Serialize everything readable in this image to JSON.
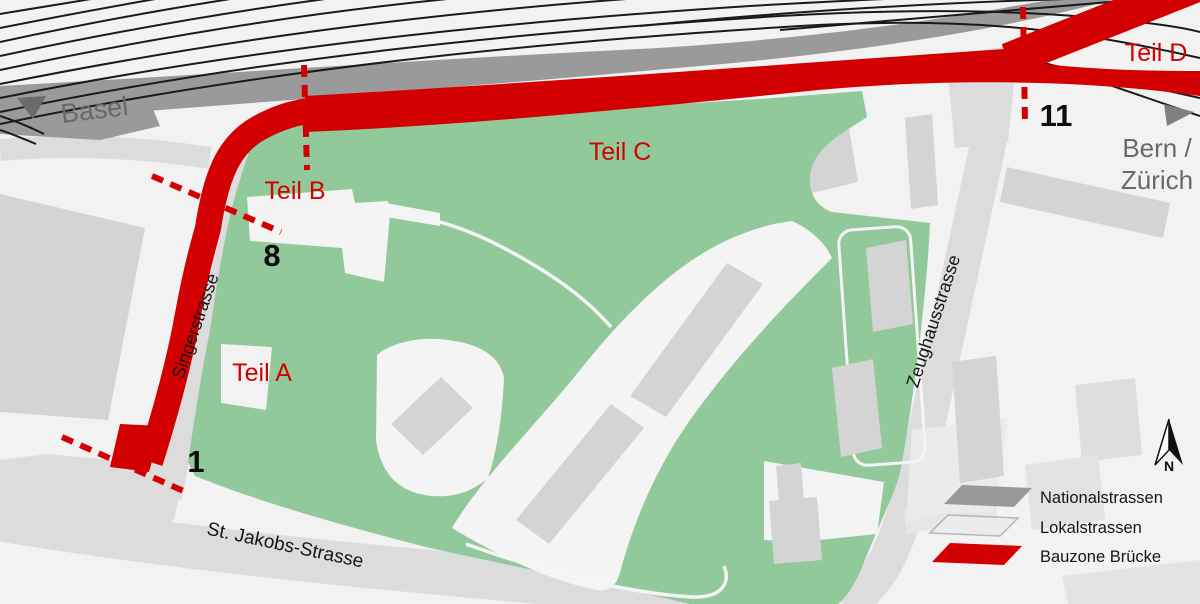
{
  "map": {
    "directions": {
      "basel": "Basel",
      "bern_zurich_line1": "Bern /",
      "bern_zurich_line2": "Zürich"
    },
    "zones": [
      {
        "id": "A",
        "label": "Teil A"
      },
      {
        "id": "B",
        "label": "Teil B"
      },
      {
        "id": "C",
        "label": "Teil C"
      },
      {
        "id": "D",
        "label": "Teil D"
      }
    ],
    "markers": [
      {
        "value": "1"
      },
      {
        "value": "8"
      },
      {
        "value": "11"
      }
    ],
    "streets": [
      {
        "name": "Singerstrasse"
      },
      {
        "name": "Zeughausstrasse"
      },
      {
        "name": "St. Jakobs-Strasse"
      }
    ],
    "legend": {
      "items": [
        {
          "label": "Nationalstrassen",
          "color": "#9a9a9a"
        },
        {
          "label": "Lokalstrassen",
          "color": "#ececec"
        },
        {
          "label": "Bauzone Brücke",
          "color": "#d20000"
        }
      ]
    },
    "compass": {
      "label": "N"
    },
    "colors": {
      "background": "#f2f2f2",
      "park": "#92c99b",
      "local_road": "#dcdcdc",
      "building": "#d4d4d4",
      "national_road": "#9a9a9a",
      "bauzone": "#d20000",
      "rail": "#1a1a1a",
      "direction_text": "#696969"
    }
  }
}
